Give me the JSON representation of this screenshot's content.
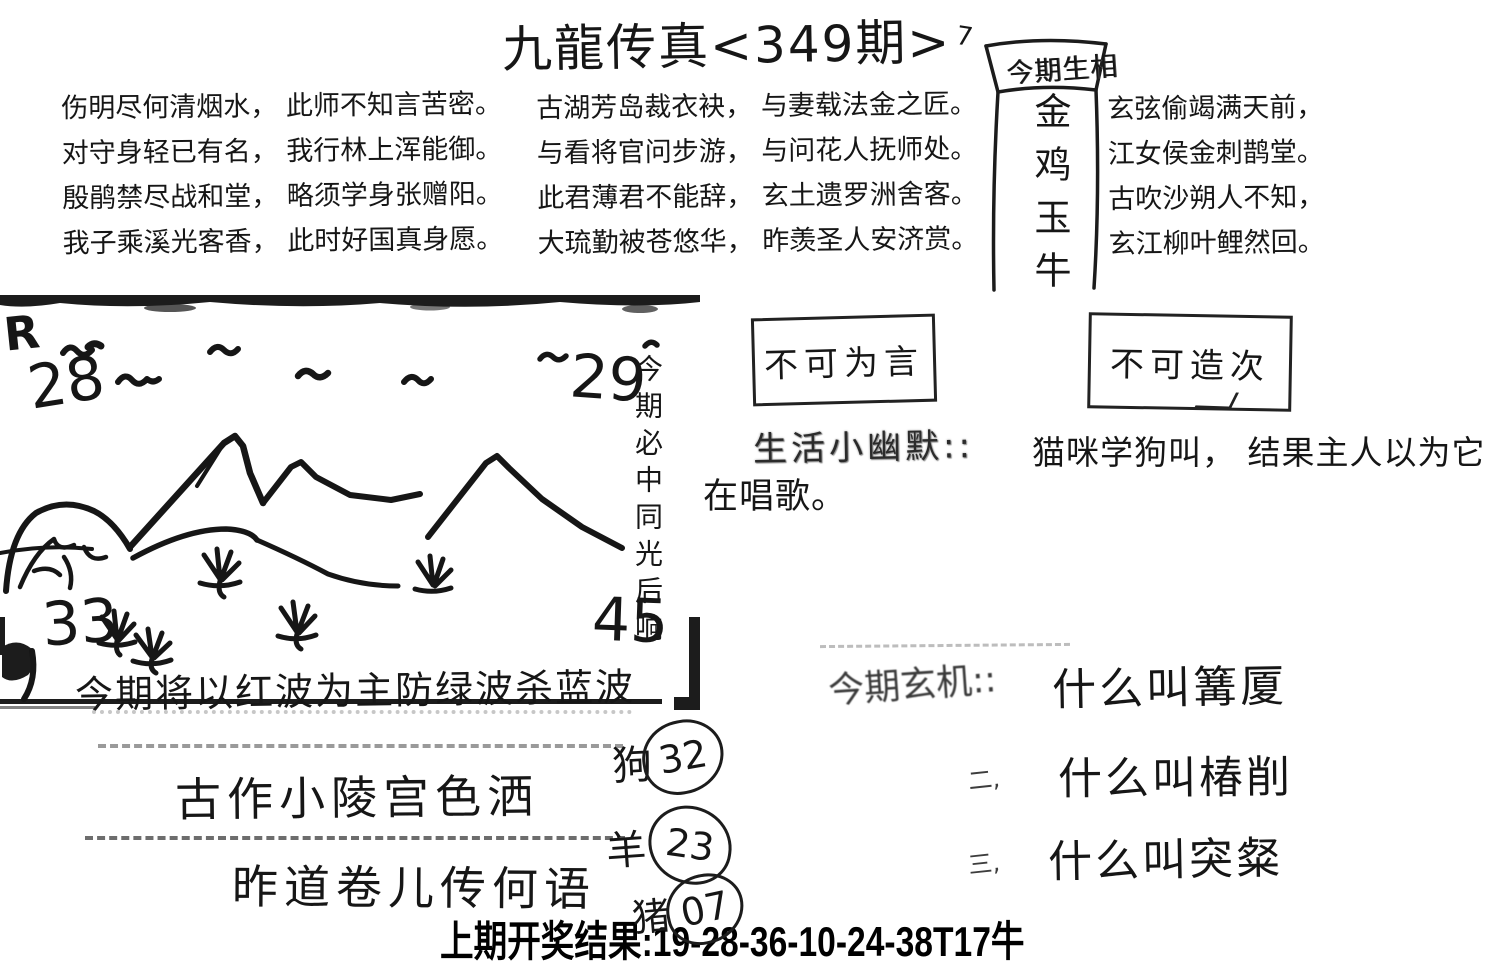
{
  "page": {
    "background": "#ffffff",
    "ink": "#161616"
  },
  "title": {
    "text": "九龍传真<349期>",
    "side_mark": "7"
  },
  "zodiac_box": {
    "header": "今期生相",
    "body": "金鸡玉牛"
  },
  "poems": {
    "left": [
      "伤明尽何清烟水， 此师不知言苦密。",
      "对守身轻已有名， 我行林上浑能御。",
      "殷鹃禁尽战和堂， 略须学身张赠阳。",
      "我子乘溪光客香， 此时好国真身愿。"
    ],
    "middle": [
      "古湖芳岛裁衣袂， 与妻载法金之匠。",
      "与看将官问步游， 与问花人抚师处。",
      "此君薄君不能辞， 玄土遗罗洲舍客。",
      "大琉勤被苍悠华， 昨羡圣人安济赏。"
    ],
    "right": [
      "玄弦偷竭满天前，",
      "江女侯金刺鹊堂。",
      "古吹沙朔人不知，",
      "玄江柳叶鲤然回。"
    ]
  },
  "drawing": {
    "corner_mark": "R",
    "numbers": {
      "top_left": "28",
      "bottom_left": "33",
      "top_right": "29",
      "bottom_right": "45"
    },
    "vertical_note": "今期必中同光后响"
  },
  "warning_boxes": {
    "box1": "不可为言",
    "box2": "不可造次"
  },
  "humor": {
    "label": "生活小幽默::",
    "line1": "猫咪学狗叫， 结果主人以为它",
    "line2": "在唱歌。"
  },
  "wave_tip": "今期将以红波为主防绿波杀蓝波",
  "slogans": {
    "line1": "古作小陵宫色洒",
    "line2": "昨道卷儿传何语"
  },
  "zodiac_picks": [
    {
      "animal": "狗",
      "number": "32"
    },
    {
      "animal": "羊",
      "number": "23"
    },
    {
      "animal": "猪",
      "number": "07"
    }
  ],
  "mystery": {
    "label": "今期玄机::",
    "items": [
      {
        "marker": "",
        "text": "什么叫篝厦"
      },
      {
        "marker": "二,",
        "text": "什么叫椿削"
      },
      {
        "marker": "三,",
        "text": "什么叫突粲"
      }
    ]
  },
  "last_result": {
    "label": "上期开奖结果:",
    "numbers": "19-28-36-10-24-38T17牛"
  }
}
